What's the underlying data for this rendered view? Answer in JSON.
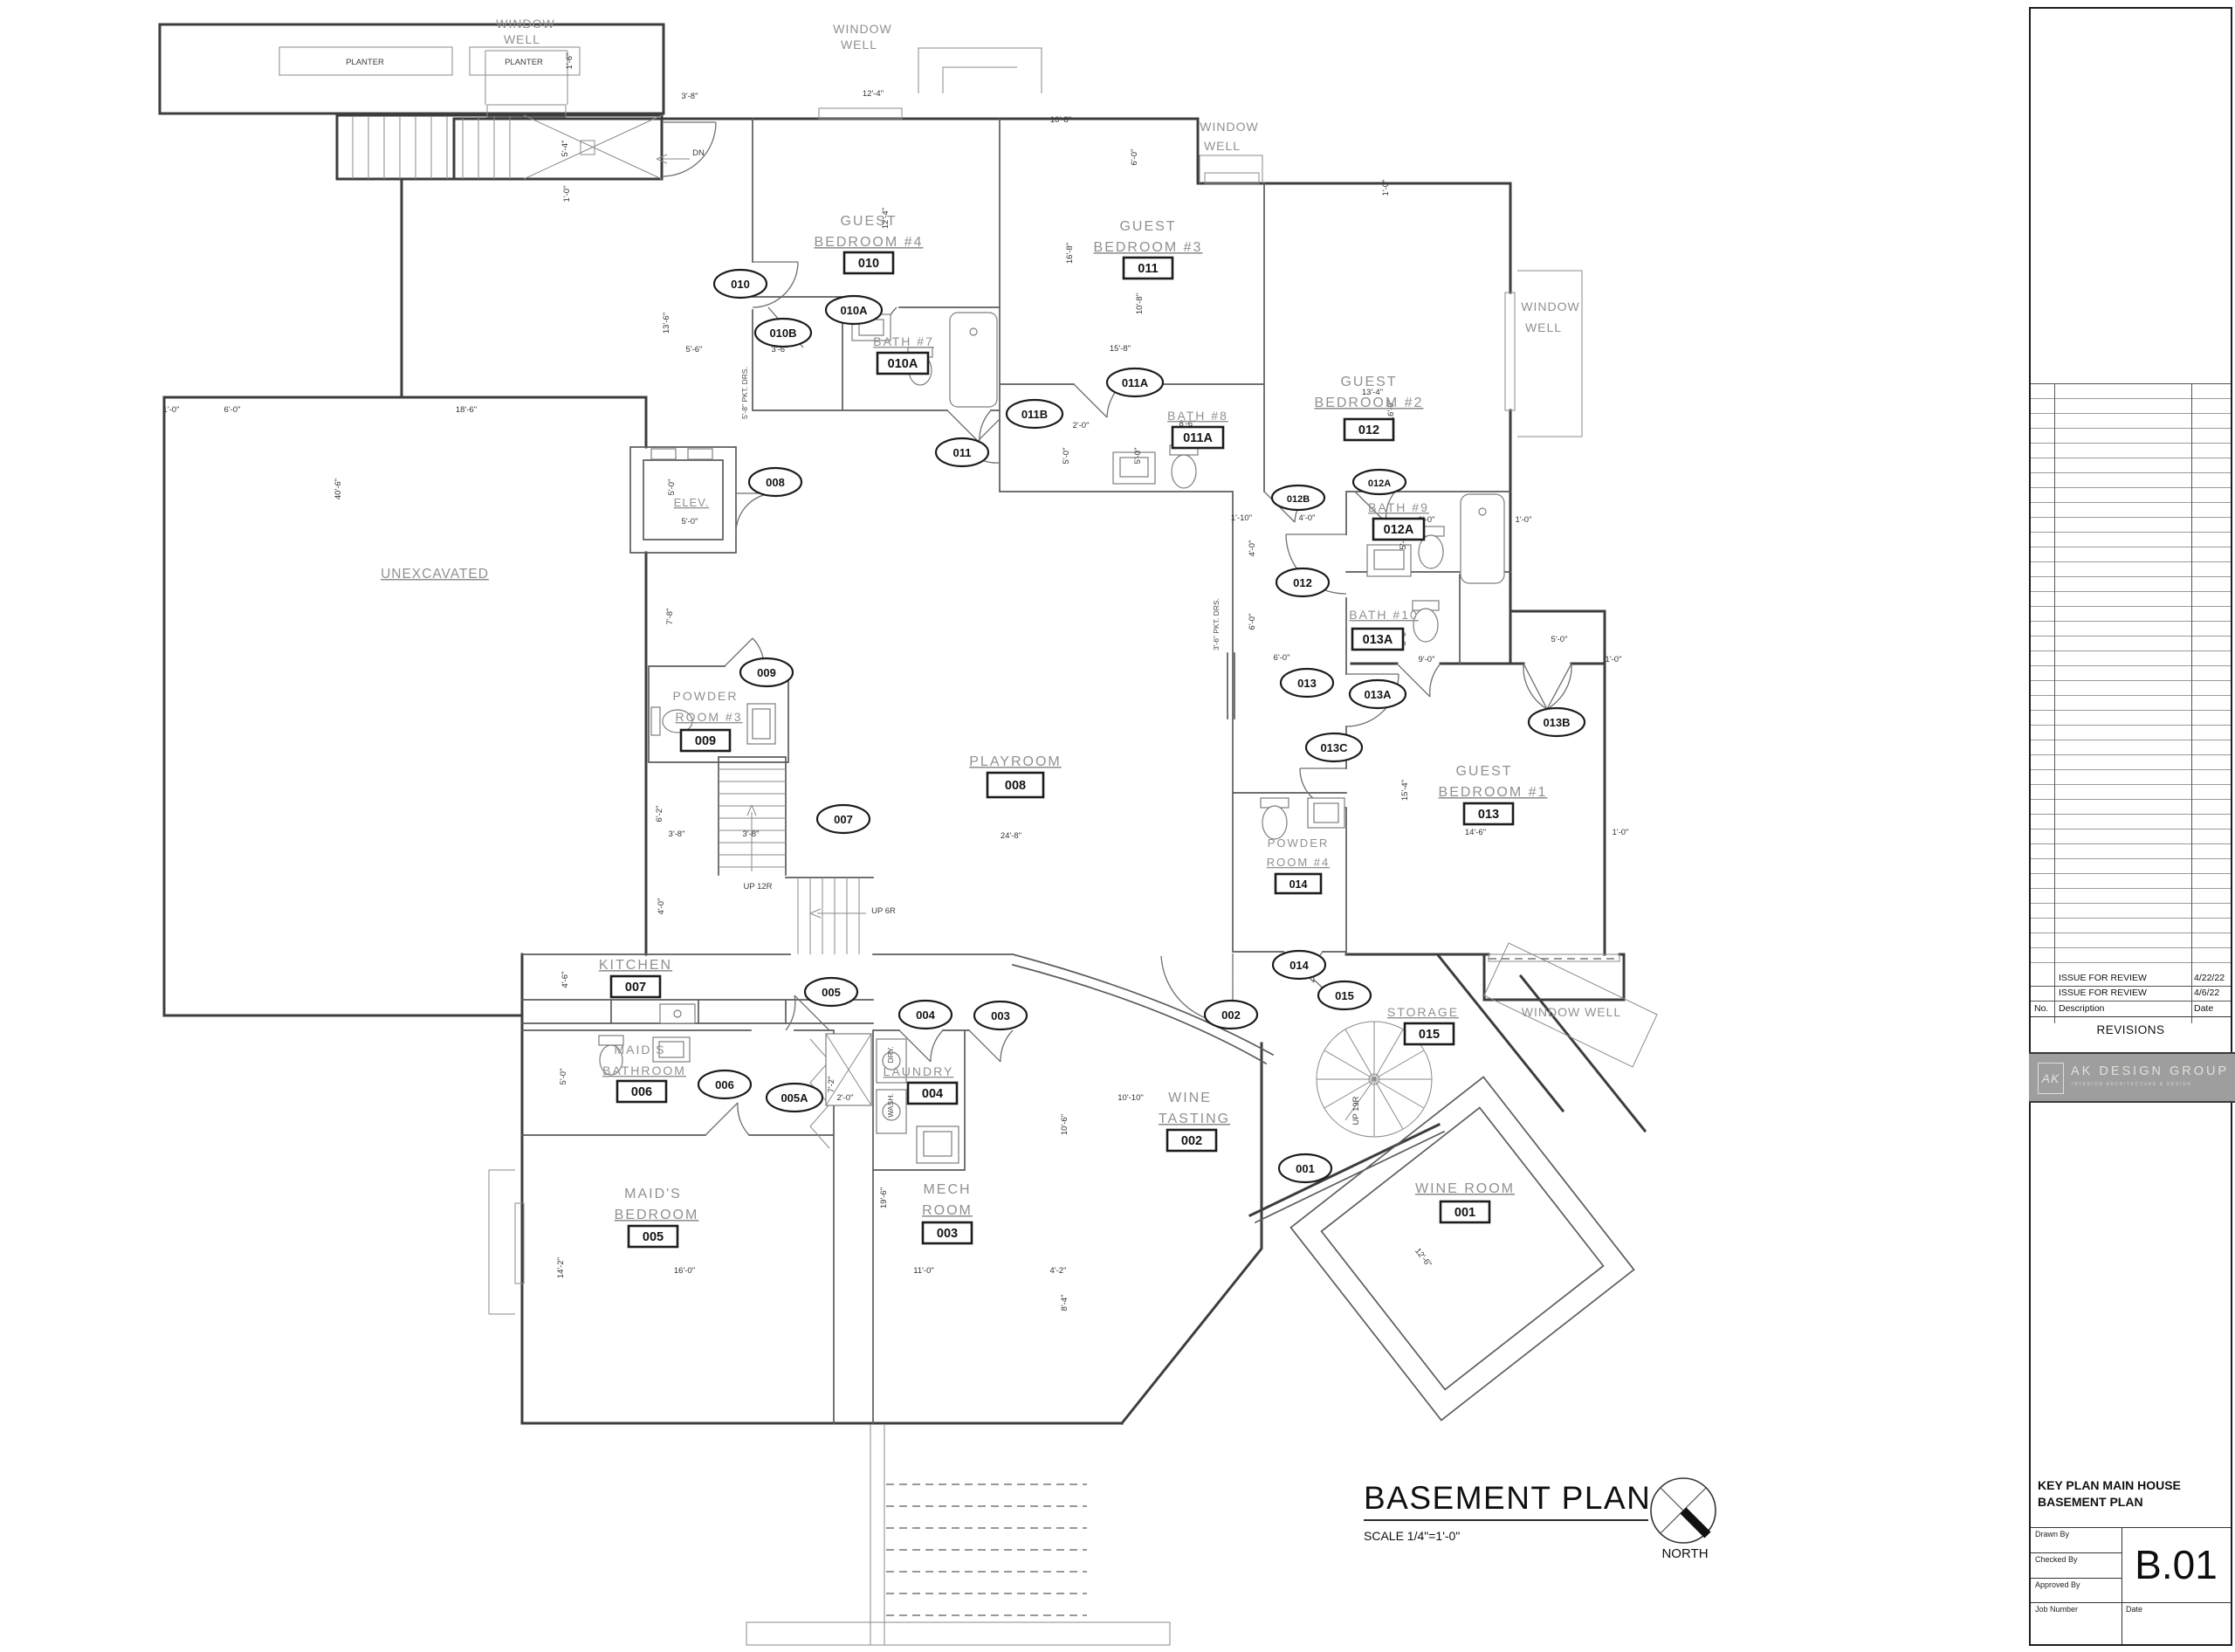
{
  "sheet": {
    "title": "BASEMENT PLAN",
    "scale": "SCALE 1/4\"=1'-0\"",
    "north": "NORTH"
  },
  "title_block": {
    "revisions_label": "REVISIONS",
    "header": {
      "no": "No.",
      "description": "Description",
      "date": "Date"
    },
    "revisions": [
      {
        "description": "ISSUE FOR REVIEW",
        "date": "4/22/22"
      },
      {
        "description": "ISSUE FOR REVIEW",
        "date": "4/6/22"
      }
    ],
    "logo": {
      "monogram": "AK",
      "name": "AK DESIGN GROUP",
      "tagline": "INTERIOR ARCHITECTURE & DESIGN"
    },
    "project_line1": "KEY PLAN MAIN HOUSE",
    "project_line2": "BASEMENT PLAN",
    "fields": {
      "drawn_by": "Drawn By",
      "checked_by": "Checked By",
      "approved_by": "Approved By",
      "job_number": "Job Number",
      "date": "Date"
    },
    "sheet_number": "B.01"
  },
  "plan": {
    "rooms": [
      {
        "l1": "GUEST",
        "l2": "BEDROOM #4",
        "num": "010"
      },
      {
        "l1": "GUEST",
        "l2": "BEDROOM #3",
        "num": "011"
      },
      {
        "l1": "GUEST",
        "l2": "BEDROOM #2",
        "num": "012"
      },
      {
        "l1": "GUEST",
        "l2": "BEDROOM #1",
        "num": "013"
      },
      {
        "l1": "BATH #7",
        "num": "010A"
      },
      {
        "l1": "BATH #8",
        "num": "011A"
      },
      {
        "l1": "BATH #9",
        "num": "012A"
      },
      {
        "l1": "BATH #10",
        "num": "013A"
      },
      {
        "l1": "POWDER",
        "l2": "ROOM #3",
        "num": "009"
      },
      {
        "l1": "POWDER",
        "l2": "ROOM #4",
        "num": "014"
      },
      {
        "l1": "PLAYROOM",
        "num": "008"
      },
      {
        "l1": "KITCHEN",
        "num": "007"
      },
      {
        "l1": "MAID'S",
        "l2": "BATHROOM",
        "num": "006"
      },
      {
        "l1": "MAID'S",
        "l2": "BEDROOM",
        "num": "005"
      },
      {
        "l1": "LAUNDRY",
        "num": "004"
      },
      {
        "l1": "MECH",
        "l2": "ROOM",
        "num": "003"
      },
      {
        "l1": "WINE",
        "l2": "TASTING",
        "num": "002"
      },
      {
        "l1": "WINE ROOM",
        "num": "001"
      },
      {
        "l1": "STORAGE",
        "num": "015"
      }
    ],
    "tags": [
      "010",
      "010A",
      "010B",
      "011",
      "011A",
      "011B",
      "012A",
      "012B",
      "012",
      "013",
      "013A",
      "013B",
      "013C",
      "008",
      "009",
      "007",
      "005",
      "005A",
      "006",
      "004",
      "003",
      "002",
      "014",
      "015",
      "001"
    ],
    "notes": [
      "PLANTER",
      "PLANTER",
      "WINDOW",
      "WELL",
      "WINDOW",
      "WELL",
      "WINDOW",
      "WELL",
      "WINDOW",
      "WELL",
      "WINDOW WELL",
      "UNEXCAVATED",
      "ELEV.",
      "UP 12R",
      "UP 6R",
      "UP 19R",
      "DN",
      "DRY.",
      "WASH.",
      "3'-6\" PKT. DRS.",
      "5'-8\" PKT. DRS."
    ],
    "dims": [
      "3'-8\"",
      "12'-4\"",
      "10'-8\"",
      "6'-0\"",
      "1'-0\"",
      "13'-4\"",
      "16'-0\"",
      "13'-6\"",
      "12'-4\"",
      "16'-8\"",
      "10'-8\"",
      "15'-8\"",
      "5'-6\"",
      "3'-6\"",
      "8'-6\"",
      "2'-0\"",
      "5'-0\"",
      "5'-0\"",
      "1'-10\"",
      "4'-0\"",
      "4'-0\"",
      "9'-0\"",
      "5'-0\"",
      "1'-0\"",
      "9'-0\"",
      "5'-0\"",
      "5'-0\"",
      "1'-0\"",
      "15'-4\"",
      "14'-6\"",
      "1'-0\"",
      "24'-8\"",
      "6'-2\"",
      "3'-8\"",
      "3'-8\"",
      "4'-0\"",
      "5'-4\"",
      "1'-6\"",
      "1'-0\"",
      "1'-0\"",
      "6'-0\"",
      "18'-6\"",
      "40'-6\"",
      "16'-0\"",
      "11'-0\"",
      "4'-2\"",
      "14'-2\"",
      "19'-6\"",
      "10'-6\"",
      "10'-10\"",
      "8'-4\"",
      "4'-6\"",
      "5'-0\"",
      "7'-2\"",
      "2'-0\"",
      "7'-8\"",
      "5'-0\"",
      "5'-0\"",
      "6'-0\"",
      "6'-0\"",
      "12'-6\""
    ]
  }
}
